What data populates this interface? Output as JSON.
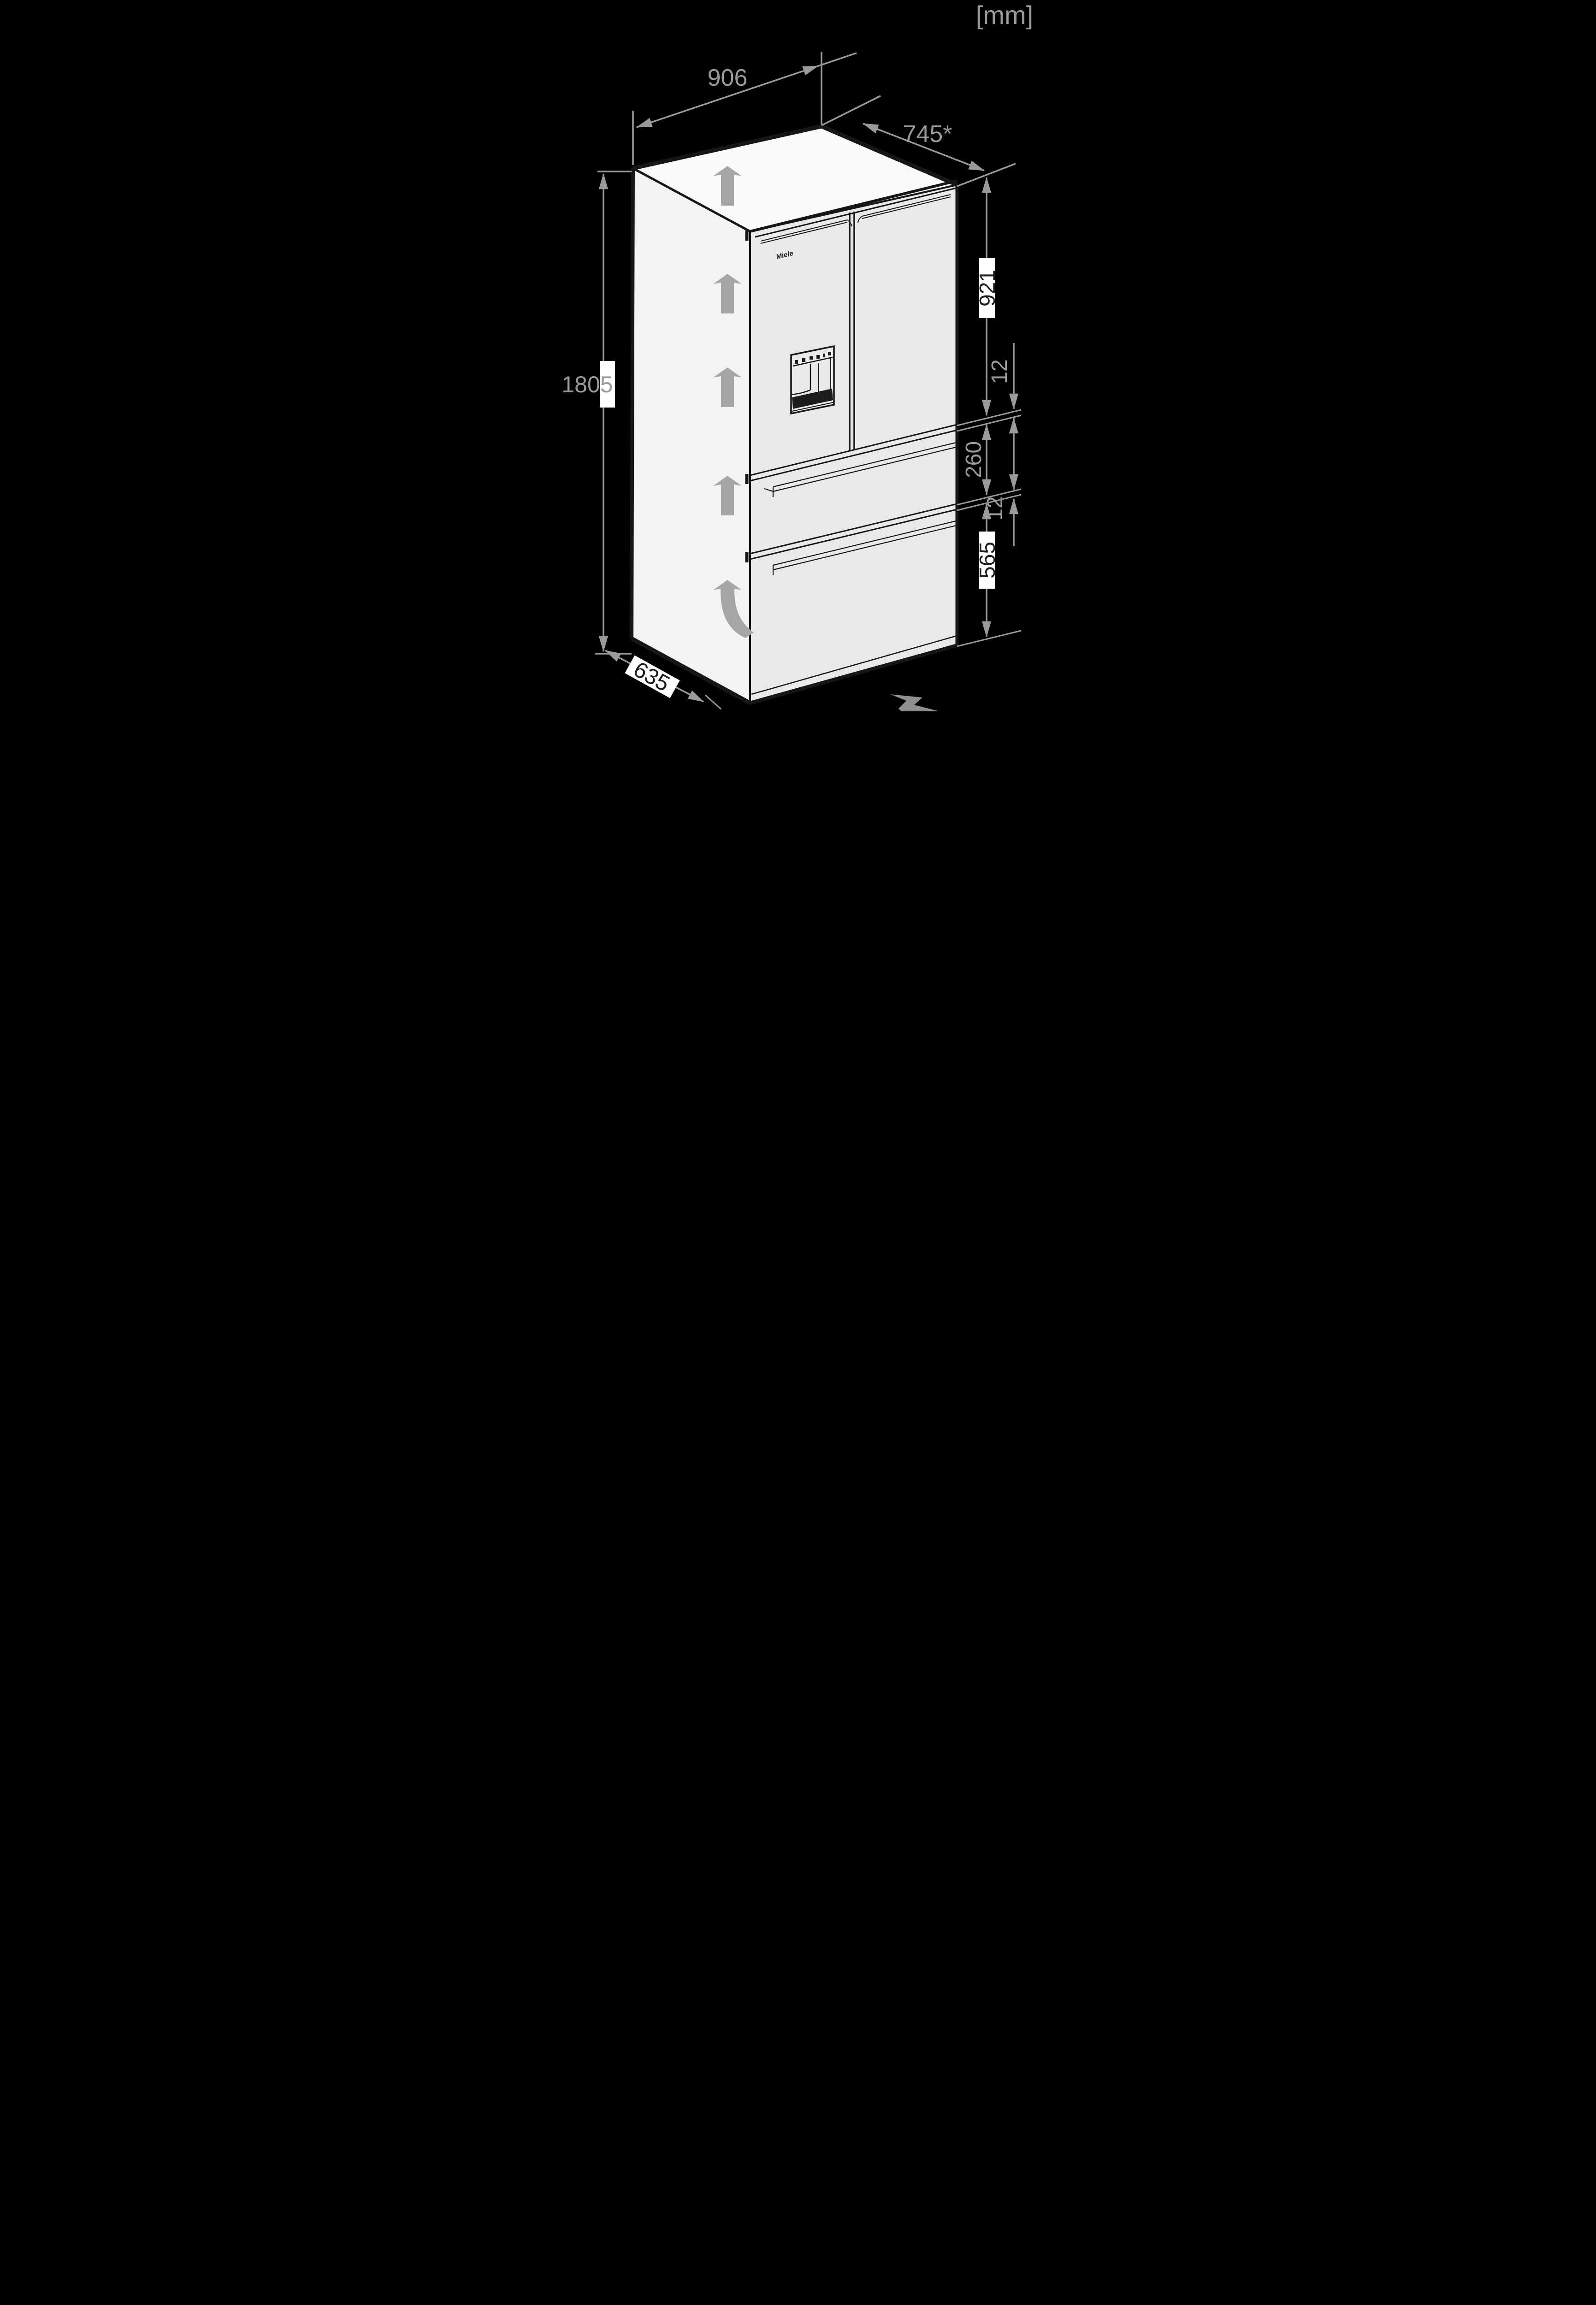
{
  "unit_label": "[mm]",
  "brand_logo": "Miele",
  "dimensions": {
    "width_top": "906",
    "depth_top": "745*",
    "height_left": "1805",
    "upper_door_height": "921",
    "gap_upper": "12",
    "middle_drawer_height": "260",
    "gap_lower": "12",
    "bottom_drawer_height": "565",
    "depth_bottom": "635"
  },
  "colors": {
    "background": "#000000",
    "annotation": "#9a9a9a",
    "label_on_box": "#1c1c1c",
    "label_box": "#ffffff",
    "fridge_side": "#f3f3f3",
    "fridge_top": "#fafafa",
    "fridge_front": "#e9e9e9",
    "outline": "#161616",
    "clearance_arrow": "#a6a6a6",
    "floor_arrow": "#8f8f8f"
  },
  "icons": {
    "up_arrows": "airflow-clearance-up-arrow",
    "curved_arrow": "airflow-curved-up-arrow",
    "floor_arrow": "viewing-direction-arrow",
    "dispenser": "water-ice-dispenser"
  }
}
